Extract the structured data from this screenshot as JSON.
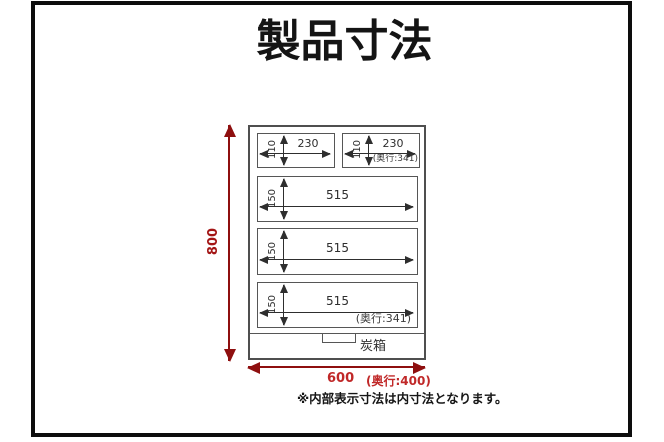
{
  "page": {
    "title": "製品寸法",
    "note": "※内部表示寸法は内寸法となります。"
  },
  "colors": {
    "frame_black": "#0d0d0d",
    "outline_gray": "#565656",
    "dimension_dark": "#2e2e2e",
    "red_arrow": "#8e0f0f",
    "red_text": "#c02828"
  },
  "diagram": {
    "overall": {
      "height": "800",
      "width": "600",
      "depth": "(奥行:400)"
    },
    "bottom_box": {
      "label": "炭箱"
    },
    "drawers": {
      "small_left": {
        "width": "230",
        "height": "110"
      },
      "small_right": {
        "width": "230",
        "height": "110",
        "depth": "(奥行:341)"
      },
      "large_top": {
        "width": "515",
        "height": "150"
      },
      "large_mid": {
        "width": "515",
        "height": "150"
      },
      "large_bot": {
        "width": "515",
        "height": "150",
        "depth": "(奥行:341)"
      }
    }
  }
}
